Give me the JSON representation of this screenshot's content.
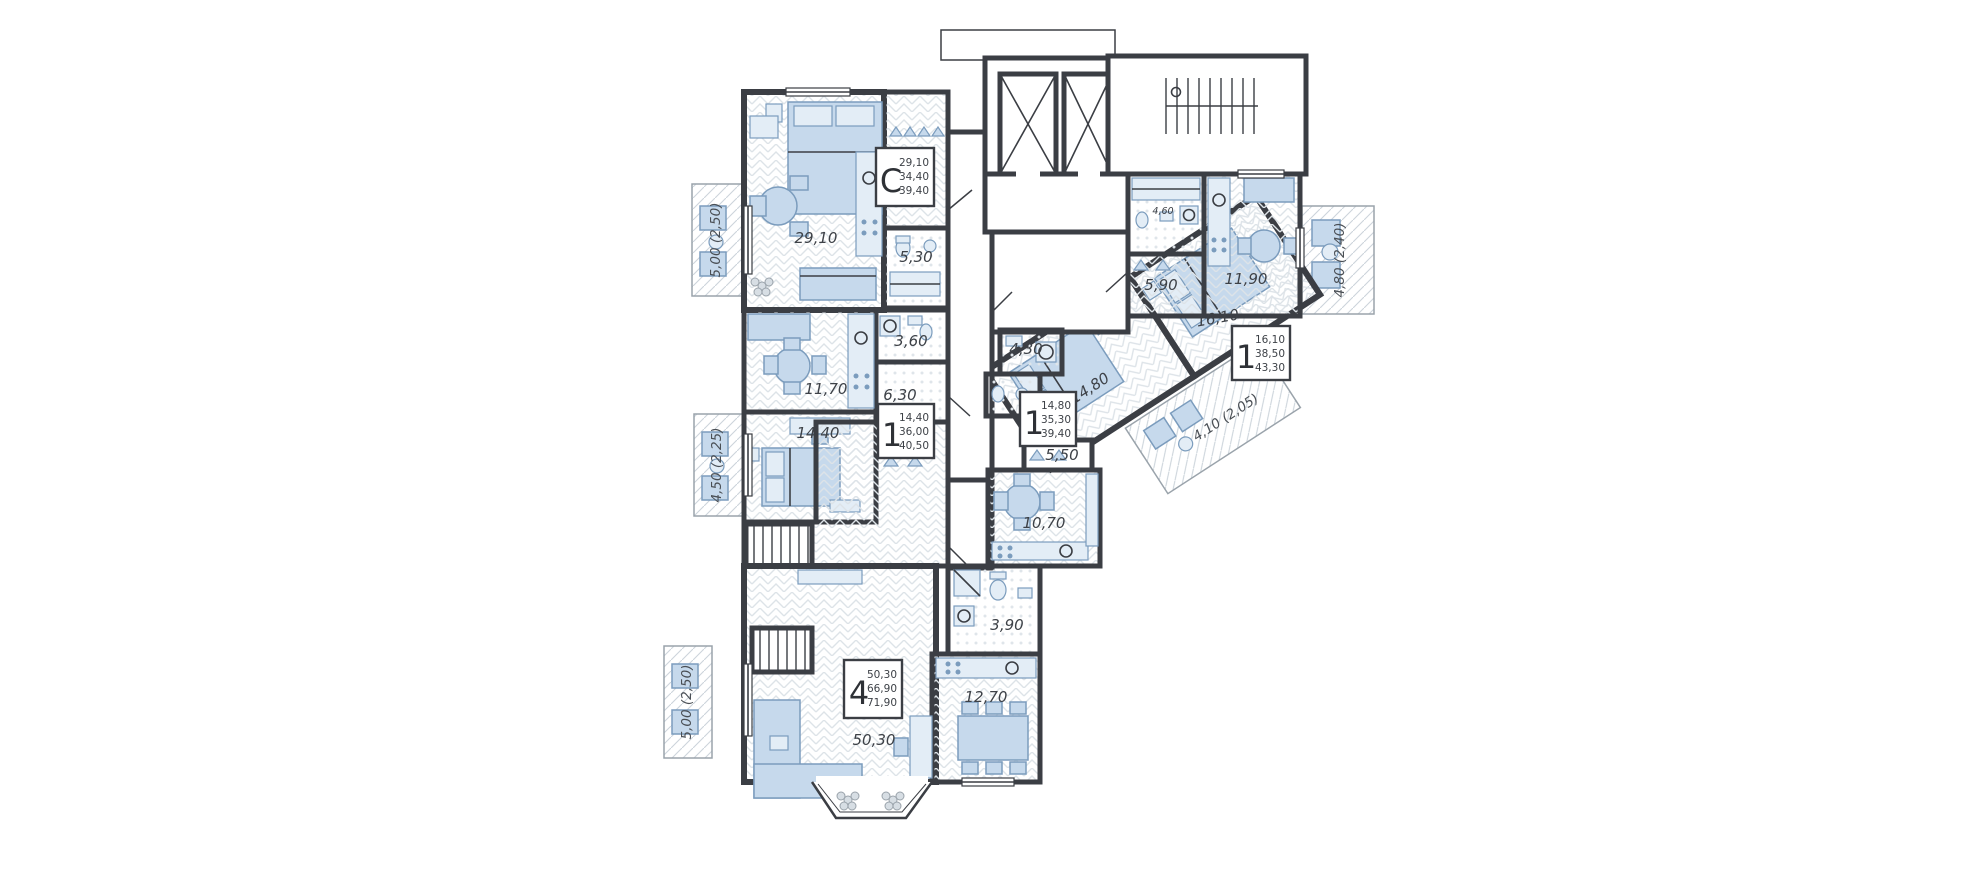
{
  "cards": [
    {
      "type": "C",
      "lines": [
        "29,10",
        "34,40",
        "39,40"
      ]
    },
    {
      "type": "1",
      "lines": [
        "14,40",
        "36,00",
        "40,50"
      ]
    },
    {
      "type": "1",
      "lines": [
        "14,80",
        "35,30",
        "39,40"
      ]
    },
    {
      "type": "1",
      "lines": [
        "16,10",
        "38,50",
        "43,30"
      ]
    },
    {
      "type": "4",
      "lines": [
        "50,30",
        "66,90",
        "71,90"
      ]
    }
  ],
  "rooms": {
    "c_living": "29,10",
    "c_bath": "5,30",
    "l1_bath": "3,60",
    "l1_living": "11,70",
    "l1_hall": "6,30",
    "l1_bed": "14,40",
    "m1_bath": "4,30",
    "m1_bed": "14,80",
    "m1_hall": "5,50",
    "m1_kitchen": "10,70",
    "r1_bath": "4,60",
    "r1_hall": "5,90",
    "r1_kitchen": "11,90",
    "r1_bed": "16,10",
    "a4_bath": "3,90",
    "a4_kitchen": "12,70",
    "a4_living": "50,30"
  },
  "balconies": {
    "c": "5,00 (2,50)",
    "l1": "4,50 (2,25)",
    "r1": "4,80 (2,40)",
    "m1": "4,10 (2,05)",
    "a4": "5,00 (2,50)"
  },
  "colors": {
    "wall": "#3b3e44",
    "furniture": "#c6d9ec",
    "hatch": "#dde3e8"
  }
}
